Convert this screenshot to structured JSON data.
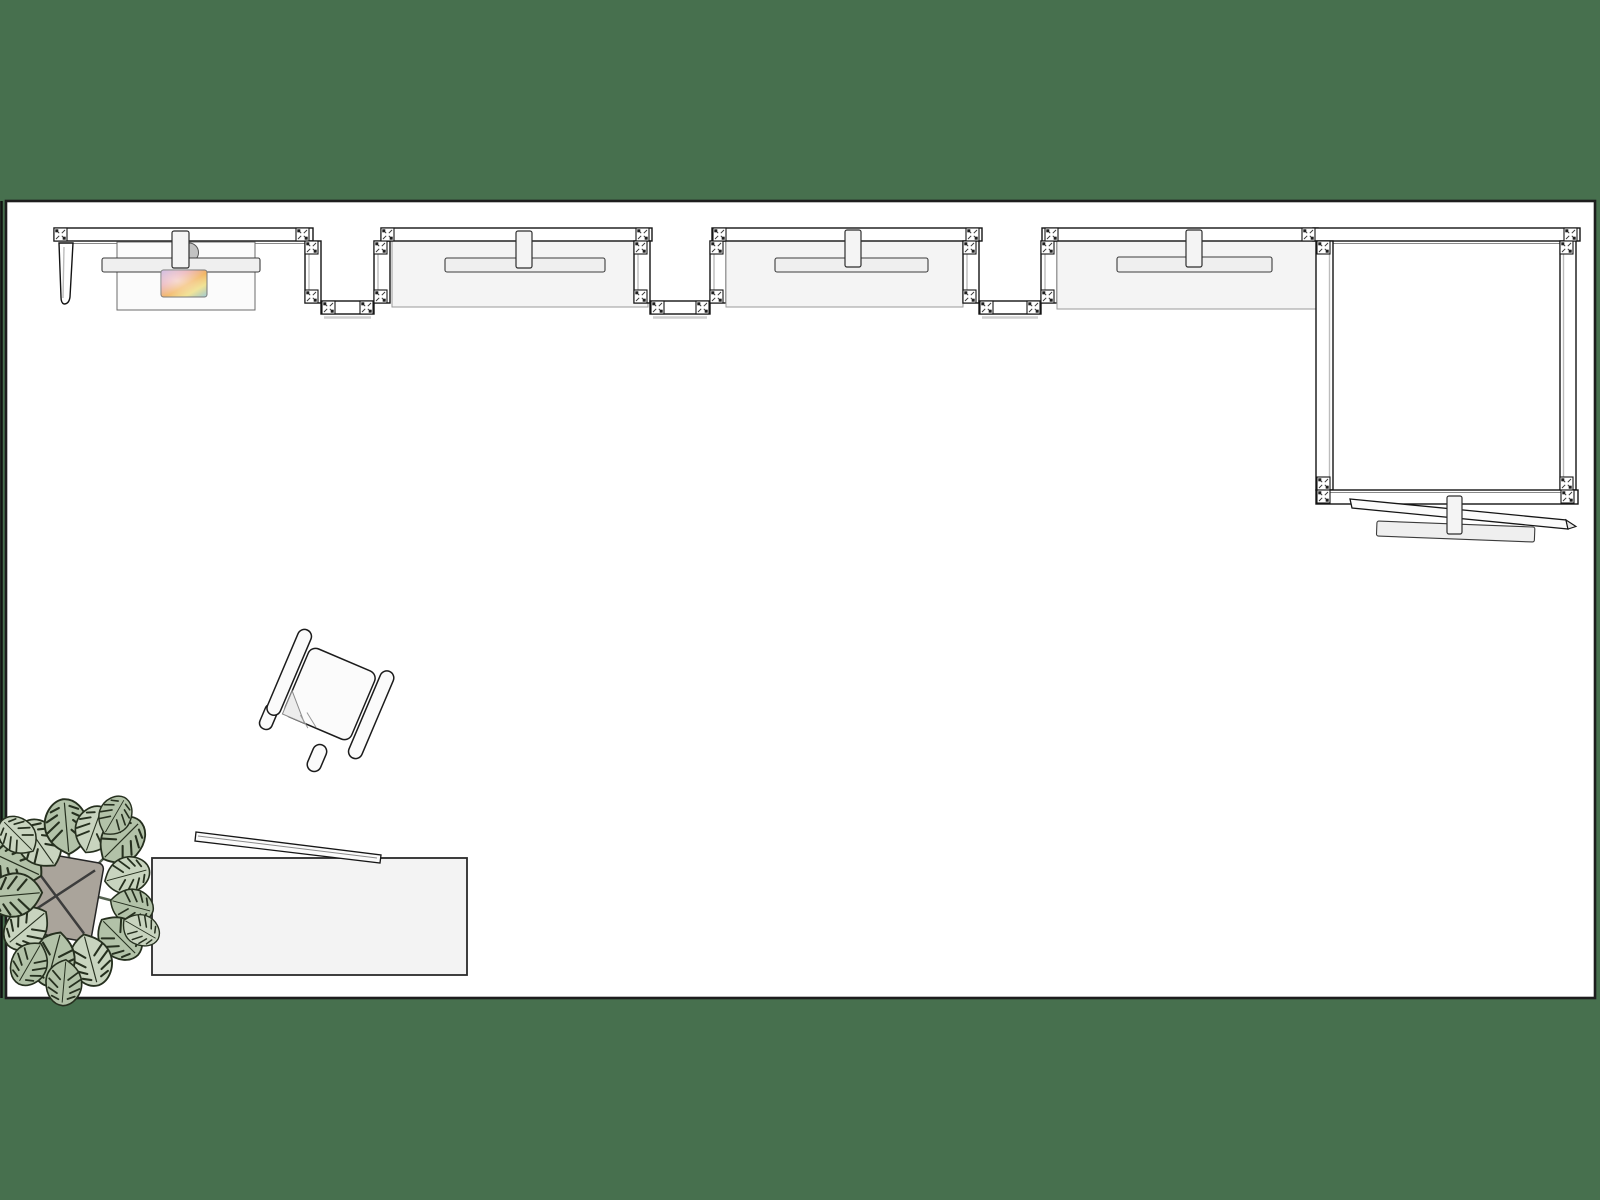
{
  "scene": {
    "type": "floor-plan-top-view",
    "description": "Top-down rendered floor plan of an exhibition space on a green backdrop: a run of modular partition walls with clamp connectors, a reception desk with abstract artwork, three display panels with shelf rails and hanging brackets, an enclosed square room with dismounted shelf rails below it, a rotated lounge chair, a sideboard table with a leaning panel, and a monstera plant in a planter.",
    "visible_text": []
  },
  "colors": {
    "background": "#47704e",
    "floor": "#ffffff",
    "floor_border": "#1d1d1d",
    "wall_fill": "#ffffff",
    "wall_stroke": "#141414",
    "panel_fill": "#f4f4f4",
    "panel_stroke": "#9a9a9a",
    "shelf_fill": "#efefef",
    "shelf_stroke": "#3c3c3c",
    "tab_fill": "#f4f4f4",
    "connector_fill": "#ffffff",
    "connector_detail": "#1f1f1f",
    "furniture_fill": "#f3f3f3",
    "furniture_stroke": "#2a2a2a",
    "chair_fill": "#fbfbfb",
    "leaf_fill": "#b2c2a8",
    "leaf_fill_light": "#c8d4bf",
    "leaf_stroke": "#26301f",
    "stem_color": "#53604f",
    "pot_fill": "#aaa49b",
    "art_1": "#c7b3e0",
    "art_2": "#e9a9b0",
    "art_3": "#f2b560",
    "art_4": "#efe08c",
    "art_5": "#9fcbd8"
  },
  "objects": {
    "floor": {
      "label": "white floor area with dark border"
    },
    "wall_run": {
      "label": "modular partition wall run",
      "bays": 4,
      "zigzag_links": 3,
      "connector_count": 34
    },
    "reception": {
      "label": "reception desk with shelf rail, wall bracket and abstract artwork"
    },
    "display_panels": {
      "label": "display panels with shelf rail and center bracket",
      "count": 3
    },
    "meeting_room": {
      "label": "enclosed square room of partition walls"
    },
    "loose_shelves": {
      "label": "dismounted shelf rails with bracket below the square room"
    },
    "chair": {
      "label": "lounge chair with armrests, rotated ~23 degrees"
    },
    "sideboard": {
      "label": "sideboard table with thin panel leaning across its top edge"
    },
    "plant": {
      "label": "monstera plant in square planter, bottom-left corner"
    }
  }
}
